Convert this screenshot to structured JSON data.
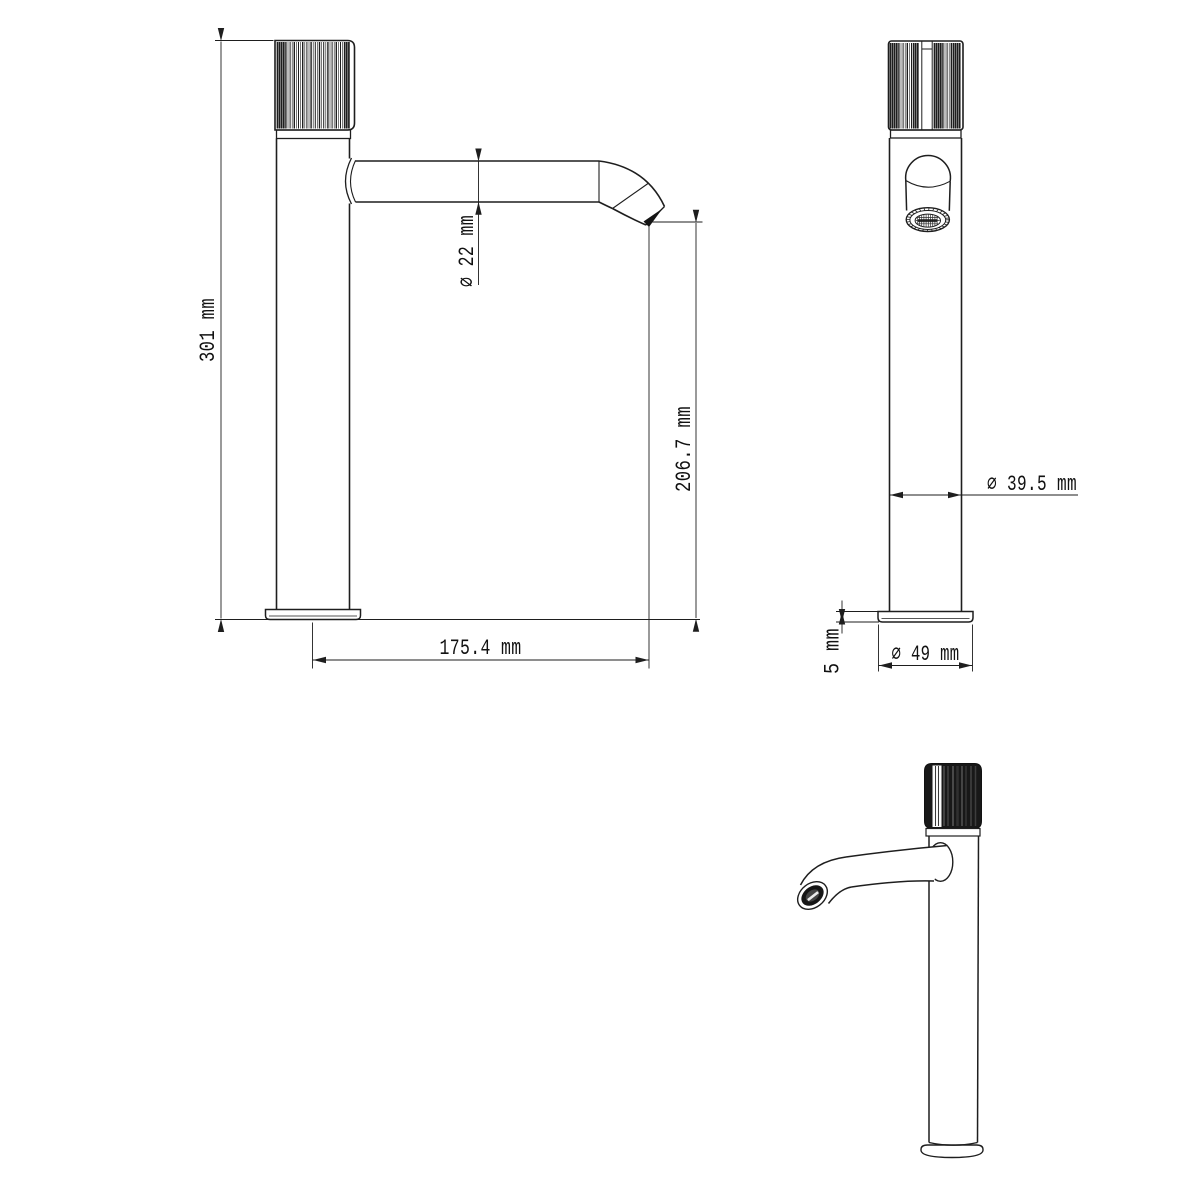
{
  "drawing": {
    "type": "faucet-technical-drawing",
    "colors": {
      "background": "#ffffff",
      "line": "#1e1e1e",
      "knurl_dark": "#181818",
      "aerator_fill": "#d9d9d9"
    },
    "dimensions": {
      "overall_height": "301 mm",
      "spout_tube_diameter": "∅ 22 mm",
      "outlet_height": "206.7 mm",
      "spout_reach": "175.4 mm",
      "body_diameter": "∅ 39.5 mm",
      "base_thickness": "5 mm",
      "base_diameter": "∅ 49 mm"
    }
  }
}
